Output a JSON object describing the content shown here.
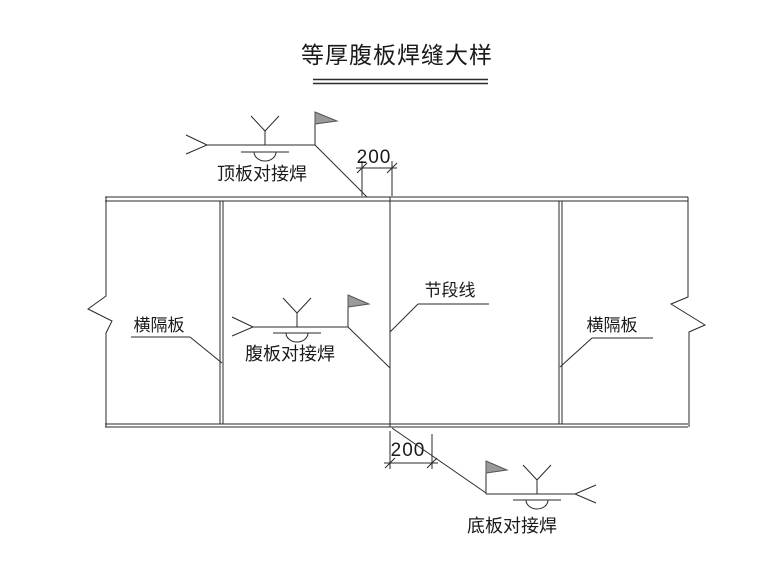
{
  "drawing": {
    "title": "等厚腹板焊缝大样",
    "labels": {
      "top_weld": "顶板对接焊",
      "web_weld": "腹板对接焊",
      "bottom_weld": "底板对接焊",
      "diaphragm_left": "横隔板",
      "diaphragm_right": "横隔板",
      "segment_line": "节段线"
    },
    "dimensions": {
      "top_offset": "200",
      "bottom_offset": "200"
    },
    "colors": {
      "line": "#2a2a2a",
      "text": "#1a1a1a",
      "flag_fill": "#9a9a9a",
      "background": "#ffffff"
    }
  }
}
